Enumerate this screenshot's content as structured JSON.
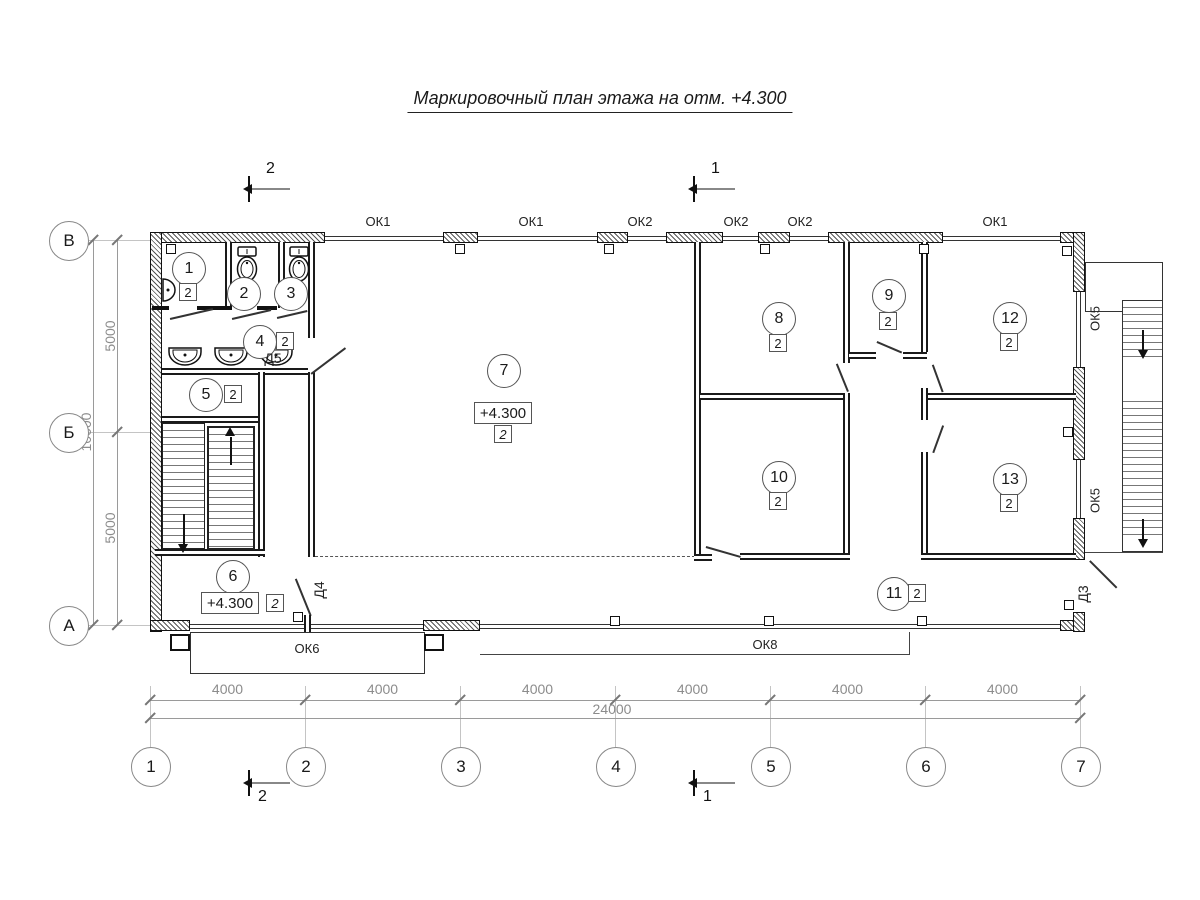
{
  "title": "Маркировочный план этажа на отм. +4.300",
  "section_marks": {
    "top_left": "2",
    "top_right": "1",
    "bottom_left": "2",
    "bottom_right": "1"
  },
  "axes": {
    "bottom": [
      "1",
      "2",
      "3",
      "4",
      "5",
      "6",
      "7"
    ],
    "left": [
      "В",
      "Б",
      "А"
    ]
  },
  "dimensions": {
    "bottom_segments": [
      "4000",
      "4000",
      "4000",
      "4000",
      "4000",
      "4000"
    ],
    "bottom_total": "24000",
    "left_segments": [
      "5000",
      "5000"
    ],
    "left_total": "10000"
  },
  "windows": {
    "top": [
      "ОК1",
      "ОК1",
      "ОК2",
      "ОК2",
      "ОК2",
      "ОК1"
    ],
    "bottom_left": "ОК6",
    "bottom_right": "ОК8",
    "right": [
      "ОК5",
      "ОК5"
    ]
  },
  "doors": {
    "d5": "Д5",
    "d4": "Д4",
    "d3": "Д3"
  },
  "rooms": [
    {
      "number": "1",
      "type": "2"
    },
    {
      "number": "2"
    },
    {
      "number": "3"
    },
    {
      "number": "4",
      "type": "2"
    },
    {
      "number": "5",
      "type": "2"
    },
    {
      "number": "6",
      "type": "2",
      "elevation": "+4.300"
    },
    {
      "number": "7",
      "type": "2",
      "elevation": "+4.300"
    },
    {
      "number": "8",
      "type": "2"
    },
    {
      "number": "9",
      "type": "2"
    },
    {
      "number": "10",
      "type": "2"
    },
    {
      "number": "11",
      "type": "2"
    },
    {
      "number": "12",
      "type": "2"
    },
    {
      "number": "13",
      "type": "2"
    }
  ]
}
